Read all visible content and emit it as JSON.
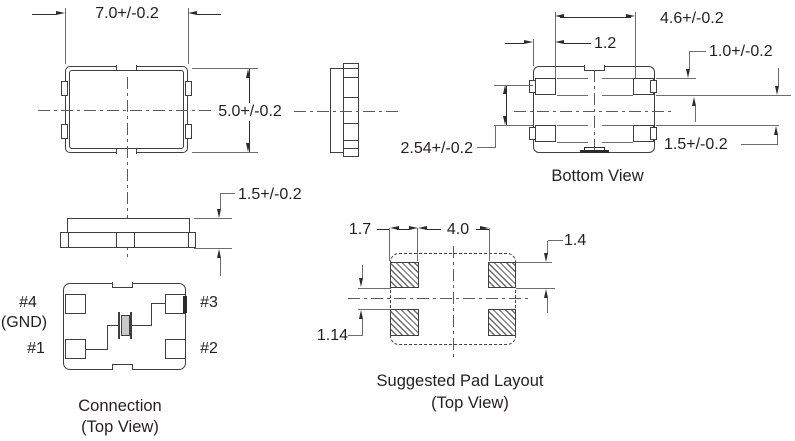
{
  "colors": {
    "line": "#3f3f3f",
    "text": "#231f20",
    "background": "#ffffff"
  },
  "top_view": {
    "width_dim": "7.0+/-0.2",
    "height_dim": "5.0+/-0.2"
  },
  "front_view": {
    "height_dim": "1.5+/-0.2"
  },
  "bottom_view": {
    "caption": "Bottom View",
    "body_width_dim": "4.6+/-0.2",
    "pad_width_dim": "1.2",
    "pad_height_dim": "1.0+/-0.2",
    "pad_pitch_dim": "2.54+/-0.2",
    "pad_gap_dim": "1.5+/-0.2"
  },
  "connection_view": {
    "caption": "Connection",
    "subcaption": "(Top View)",
    "pin1_label": "#1",
    "pin2_label": "#2",
    "pin3_label": "#3",
    "pin4_label": "#4",
    "pin4_note": "(GND)"
  },
  "pad_layout": {
    "caption": "Suggested Pad Layout",
    "subcaption": "(Top View)",
    "pad_width_dim": "1.7",
    "pad_inner_gap_dim": "4.0",
    "pad_height_dim": "1.4",
    "pad_vertical_gap_dim": "1.14"
  }
}
